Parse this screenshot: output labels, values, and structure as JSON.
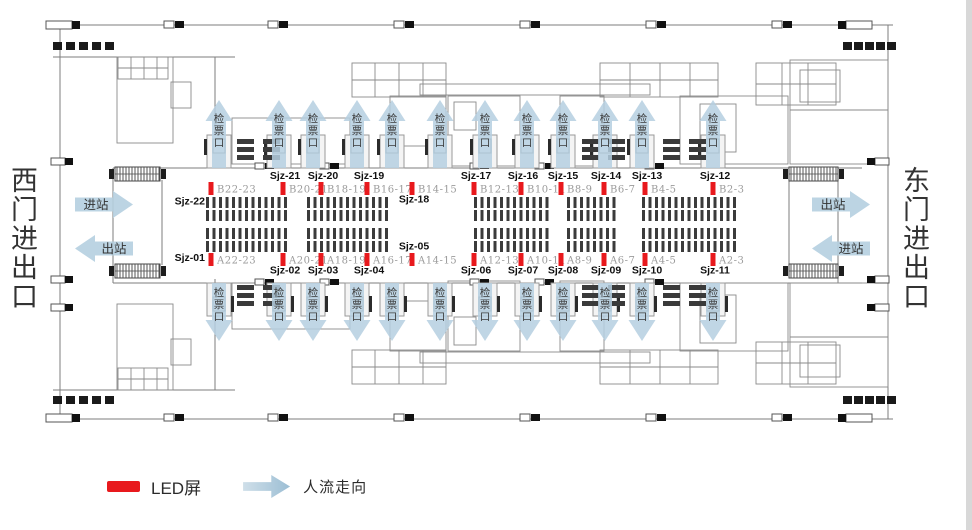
{
  "colors": {
    "arrow_blue": "#b5cfe0",
    "led_red": "#e8191d",
    "gate_code_grey": "#9b9b9b",
    "id_black": "#111111",
    "wall_grey": "#7d7d7d",
    "text_dark": "#333333"
  },
  "west_gate_label": "西门进出口",
  "east_gate_label": "东门进出口",
  "checkpoint_label": "检票口",
  "flows": {
    "west": [
      {
        "label": "进站",
        "dir": "right"
      },
      {
        "label": "出站",
        "dir": "left"
      }
    ],
    "east": [
      {
        "label": "出站",
        "dir": "right"
      },
      {
        "label": "进站",
        "dir": "left"
      }
    ]
  },
  "checkpoints": {
    "top_x": [
      219,
      279,
      313,
      357,
      392,
      440,
      485,
      527,
      563,
      605,
      642,
      713
    ],
    "bottom_x": [
      219,
      279,
      313,
      357,
      392,
      440,
      485,
      527,
      563,
      605,
      642,
      713
    ]
  },
  "led_screens": {
    "top": [
      {
        "id": "Sjz-22",
        "gate": "B22-23",
        "x": 211,
        "id_pos": "left_low"
      },
      {
        "id": "Sjz-21",
        "gate": "B20-21",
        "x": 283,
        "id_pos": "above"
      },
      {
        "id": "Sjz-20",
        "gate": "B18-19",
        "x": 321,
        "id_pos": "above"
      },
      {
        "id": "Sjz-19",
        "gate": "B16-17",
        "x": 367,
        "id_pos": "above"
      },
      {
        "id": "Sjz-18",
        "gate": "B14-15",
        "x": 412,
        "id_pos": "below"
      },
      {
        "id": "Sjz-17",
        "gate": "B12-13",
        "x": 474,
        "id_pos": "above"
      },
      {
        "id": "Sjz-16",
        "gate": "B10-11",
        "x": 521,
        "id_pos": "above"
      },
      {
        "id": "Sjz-15",
        "gate": "B8-9",
        "x": 561,
        "id_pos": "above"
      },
      {
        "id": "Sjz-14",
        "gate": "B6-7",
        "x": 604,
        "id_pos": "above"
      },
      {
        "id": "Sjz-13",
        "gate": "B4-5",
        "x": 645,
        "id_pos": "above"
      },
      {
        "id": "Sjz-12",
        "gate": "B2-3",
        "x": 713,
        "id_pos": "above"
      }
    ],
    "bottom": [
      {
        "id": "Sjz-01",
        "gate": "A22-23",
        "x": 211,
        "id_pos": "left_high"
      },
      {
        "id": "Sjz-02",
        "gate": "A20-21",
        "x": 283,
        "id_pos": "below"
      },
      {
        "id": "Sjz-03",
        "gate": "A18-19",
        "x": 321,
        "id_pos": "below"
      },
      {
        "id": "Sjz-04",
        "gate": "A16-17",
        "x": 367,
        "id_pos": "below"
      },
      {
        "id": "Sjz-05",
        "gate": "A14-15",
        "x": 412,
        "id_pos": "above"
      },
      {
        "id": "Sjz-06",
        "gate": "A12-13",
        "x": 474,
        "id_pos": "below"
      },
      {
        "id": "Sjz-07",
        "gate": "A10-11",
        "x": 521,
        "id_pos": "below"
      },
      {
        "id": "Sjz-08",
        "gate": "A8-9",
        "x": 561,
        "id_pos": "below"
      },
      {
        "id": "Sjz-09",
        "gate": "A6-7",
        "x": 604,
        "id_pos": "below"
      },
      {
        "id": "Sjz-10",
        "gate": "A4-5",
        "x": 645,
        "id_pos": "below"
      },
      {
        "id": "Sjz-11",
        "gate": "A2-3",
        "x": 713,
        "id_pos": "below"
      }
    ]
  },
  "legend": {
    "led": "LED屏",
    "flow": "人流走向"
  }
}
